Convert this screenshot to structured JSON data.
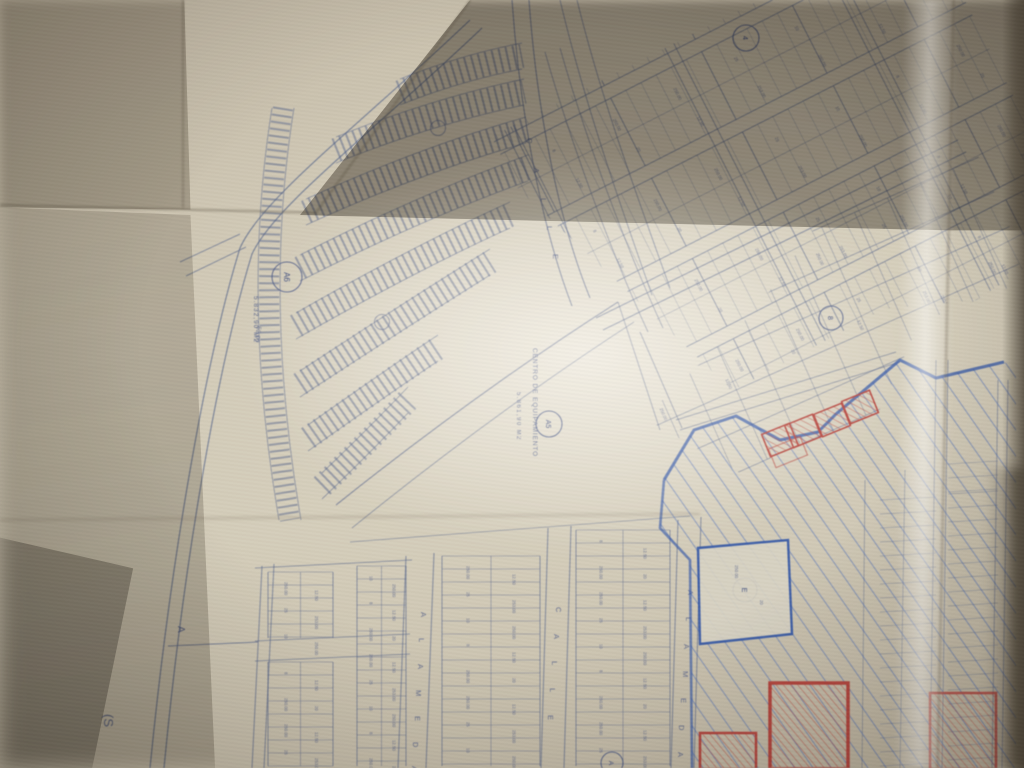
{
  "map": {
    "streets": [
      {
        "id": "calle_top",
        "name": "CALLE"
      },
      {
        "id": "calle_bottom",
        "name": "CALLE"
      },
      {
        "id": "alameda_west",
        "name": "ALAMEDA"
      },
      {
        "id": "alameda_east",
        "name": "ALAMEDA"
      }
    ],
    "labels": {
      "center_facility_name": "CENTRO DE EQUIPAMIENTO",
      "center_facility_area": "5.861,90 M2",
      "block_a6_area": "5.832,90 M2",
      "road_dimension": "52,00",
      "margin_note": "(S",
      "section_marker": "A"
    },
    "block_circles": [
      {
        "id": "a6",
        "text": "A6"
      },
      {
        "id": "a5",
        "text": "A5"
      },
      {
        "id": "top_block",
        "text": "4"
      },
      {
        "id": "mid_block",
        "text": "8"
      },
      {
        "id": "reserved_parcel",
        "text": "E"
      },
      {
        "id": "bottom_block",
        "text": "A"
      }
    ],
    "parcel_number_samples": [
      "250.00",
      "12.50",
      "25",
      "253.00",
      "10",
      "250.00",
      "8",
      "12.50",
      "250.00",
      "20"
    ]
  },
  "colors": {
    "print_blue": "#56668f",
    "print_blue_dark": "#46568a",
    "hand_blue": "#3a63bd",
    "hand_red": "#c0443c",
    "paper": "#d9d3c2"
  }
}
